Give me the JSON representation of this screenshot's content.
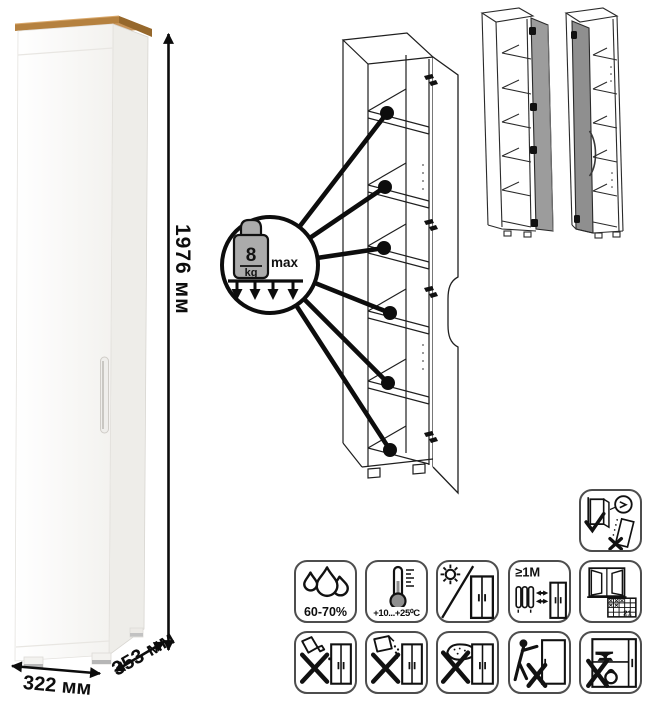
{
  "dimensions": {
    "height": "1976 мм",
    "width": "322 мм",
    "depth": "353 мм"
  },
  "load_limit": {
    "value": "8",
    "unit": "kg",
    "qualifier": "max"
  },
  "icons": {
    "anchor": {
      "name": "anchor-to-wall-icon",
      "label": ""
    },
    "row1": [
      {
        "name": "humidity-icon",
        "label": "60-70%"
      },
      {
        "name": "temperature-icon",
        "label": "+10...+25⁰C"
      },
      {
        "name": "no-direct-sunlight-icon",
        "label": ""
      },
      {
        "name": "heat-distance-icon",
        "label": "≥1М"
      },
      {
        "name": "ventilation-calendar-icon",
        "label": "21"
      }
    ],
    "row2": [
      {
        "name": "no-aggressive-liquids-icon",
        "label": ""
      },
      {
        "name": "no-abrasive-powders-icon",
        "label": ""
      },
      {
        "name": "no-wet-sponge-icon",
        "label": ""
      },
      {
        "name": "do-not-drag-icon",
        "label": ""
      },
      {
        "name": "do-not-overload-icon",
        "label": ""
      }
    ]
  },
  "colors": {
    "wood_top": "#b5813f",
    "wood_top_dark": "#96682c",
    "cabinet_front": "#fafaf8",
    "cabinet_side": "#eeede9",
    "drawing_line": "#1f1f1f",
    "mini_door_gray": "#9c9c9c",
    "icon_border": "#4d4d4d"
  }
}
